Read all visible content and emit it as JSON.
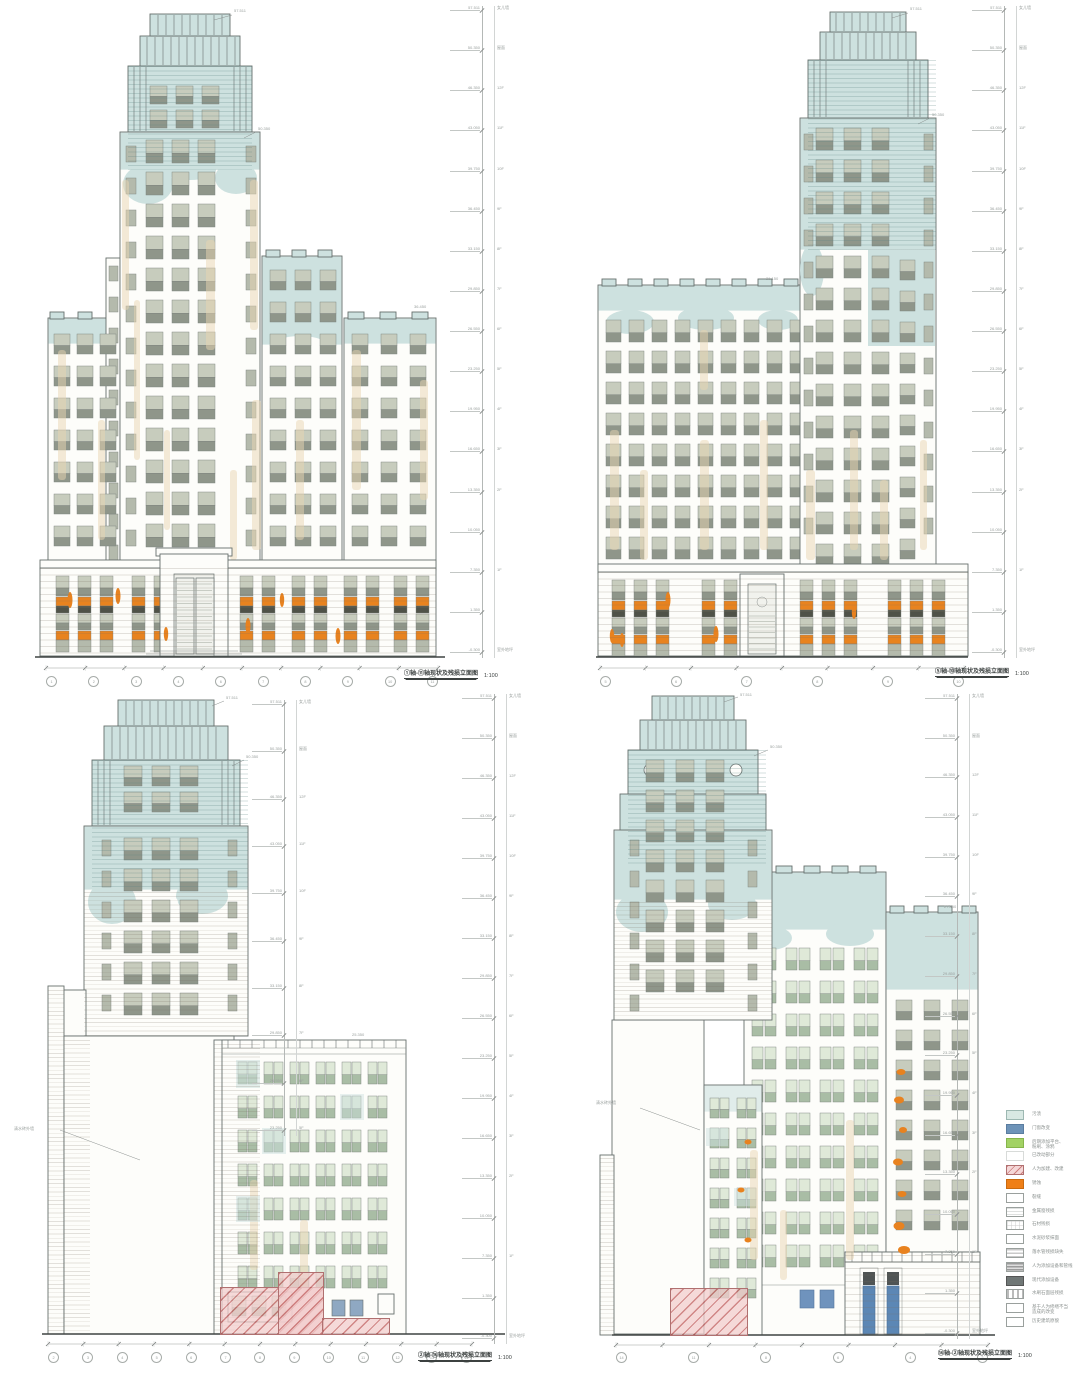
{
  "page": {
    "background": "#ffffff",
    "drawing_type": "现状及残损立面图"
  },
  "panels": [
    {
      "caption": "①轴-⑪轴现状及残损立面图",
      "scale": "1:100",
      "peak_labels": [
        "57.511",
        "50.350"
      ],
      "wing_label": "36.450",
      "axes": [
        "1",
        "2",
        "3",
        "4",
        "6",
        "7",
        "8",
        "9",
        "10",
        "11"
      ],
      "levels": [
        [
          "57.511",
          "女儿墙"
        ],
        [
          "50.350",
          "屋面"
        ],
        [
          "46.350",
          "12F"
        ],
        [
          "43.050",
          "11F"
        ],
        [
          "39.750",
          "10F"
        ],
        [
          "36.450",
          "9F"
        ],
        [
          "33.150",
          "8F"
        ],
        [
          "29.850",
          "7F"
        ],
        [
          "26.550",
          "6F"
        ],
        [
          "23.250",
          "5F"
        ],
        [
          "19.950",
          "4F"
        ],
        [
          "16.650",
          "3F"
        ],
        [
          "13.350",
          "2F"
        ],
        [
          "10.050",
          ""
        ],
        [
          "7.350",
          "1F"
        ],
        [
          "1.350",
          ""
        ],
        [
          "-0.300",
          "室外地坪"
        ]
      ]
    },
    {
      "caption": "⑤轴-⑩轴现状及残损立面图",
      "scale": "1:100",
      "peak_labels": [
        "57.511",
        "50.350"
      ],
      "wing_label": "31.150",
      "axes": [
        "5",
        "6",
        "7",
        "8",
        "9",
        "10"
      ],
      "levels": [
        [
          "57.511",
          "女儿墙"
        ],
        [
          "50.350",
          "屋面"
        ],
        [
          "46.350",
          "12F"
        ],
        [
          "43.050",
          "11F"
        ],
        [
          "39.750",
          "10F"
        ],
        [
          "36.450",
          "9F"
        ],
        [
          "33.150",
          "8F"
        ],
        [
          "29.850",
          "7F"
        ],
        [
          "26.550",
          "6F"
        ],
        [
          "23.250",
          "5F"
        ],
        [
          "19.950",
          "4F"
        ],
        [
          "16.650",
          "3F"
        ],
        [
          "13.350",
          "2F"
        ],
        [
          "10.050",
          ""
        ],
        [
          "7.350",
          "1F"
        ],
        [
          "1.350",
          ""
        ],
        [
          "-0.300",
          "室外地坪"
        ]
      ]
    },
    {
      "caption": "②轴-⑭轴现状及残损立面图",
      "scale": "1:100",
      "peak_labels": [
        "57.511",
        "50.350"
      ],
      "wing_label": "25.350",
      "note": "清水砖外墙",
      "axes": [
        "2",
        "3",
        "4",
        "5",
        "6",
        "7",
        "8",
        "9",
        "10",
        "11",
        "12",
        "13",
        "14"
      ],
      "levels": [
        [
          "57.511",
          "女儿墙"
        ],
        [
          "50.350",
          "屋面"
        ],
        [
          "46.350",
          "12F"
        ],
        [
          "43.050",
          "11F"
        ],
        [
          "39.750",
          "10F"
        ],
        [
          "36.450",
          "9F"
        ],
        [
          "33.150",
          "8F"
        ],
        [
          "29.850",
          "7F"
        ],
        [
          "26.550",
          "6F"
        ],
        [
          "23.250",
          "5F"
        ],
        [
          "19.950",
          "4F"
        ],
        [
          "16.650",
          "3F"
        ],
        [
          "13.350",
          "2F"
        ],
        [
          "10.050",
          ""
        ],
        [
          "7.350",
          "1F"
        ],
        [
          "1.350",
          ""
        ],
        [
          "-0.300",
          "室外地坪"
        ]
      ]
    },
    {
      "caption": "⑭轴-②轴现状及残损立面图",
      "scale": "1:100",
      "peak_labels": [
        "57.511",
        "50.350"
      ],
      "wing_label": "27.850",
      "note": "清水砖外墙",
      "axes": [
        "14",
        "11",
        "8",
        "6",
        "4",
        "2"
      ],
      "levels": [
        [
          "57.511",
          "女儿墙"
        ],
        [
          "50.350",
          "屋面"
        ],
        [
          "46.350",
          "12F"
        ],
        [
          "43.050",
          "11F"
        ],
        [
          "39.750",
          "10F"
        ],
        [
          "36.450",
          "9F"
        ],
        [
          "33.150",
          "8F"
        ],
        [
          "29.850",
          "7F"
        ],
        [
          "26.550",
          "6F"
        ],
        [
          "23.250",
          "5F"
        ],
        [
          "19.950",
          "4F"
        ],
        [
          "16.650",
          "3F"
        ],
        [
          "13.350",
          "2F"
        ],
        [
          "10.050",
          ""
        ],
        [
          "7.350",
          "1F"
        ],
        [
          "1.350",
          ""
        ],
        [
          "-0.300",
          "室外地坪"
        ]
      ]
    }
  ],
  "legend": {
    "items": [
      {
        "swatch": "cyan",
        "label": "污渍"
      },
      {
        "swatch": "blue",
        "label": "门窗改变"
      },
      {
        "swatch": "green",
        "label": "后期添加平台、\n粉刷、涂鸦"
      },
      {
        "swatch": "blank",
        "label": "已改动部分"
      },
      {
        "swatch": "pink",
        "label": "人为加建、改建"
      },
      {
        "swatch": "orange",
        "label": "锈蚀"
      },
      {
        "swatch": "plain",
        "label": "裂缝"
      },
      {
        "swatch": "lines",
        "label": "金属窗残损"
      },
      {
        "swatch": "grid",
        "label": "石材残损"
      },
      {
        "swatch": "plain",
        "label": "水泥砂浆抹面"
      },
      {
        "swatch": "stripes",
        "label": "落水管残损缺失"
      },
      {
        "swatch": "graystripes",
        "label": "人为添加设备和管线"
      },
      {
        "swatch": "darkgray",
        "label": "现代添加设备"
      },
      {
        "swatch": "dashes",
        "label": "水刷石面层残损"
      },
      {
        "swatch": "plain",
        "label": "基于人为修缮不当\n造成的改变"
      },
      {
        "swatch": "plain",
        "label": "历史建筑原貌"
      }
    ]
  },
  "colors": {
    "facade_blue": "#cde1df",
    "stain_beige": "#e9d6b1",
    "rust_orange": "#e8821f",
    "demolish_pink": "#e0a3a3",
    "door_blue": "#5c87b5",
    "equipment_gray": "#4f5454"
  }
}
